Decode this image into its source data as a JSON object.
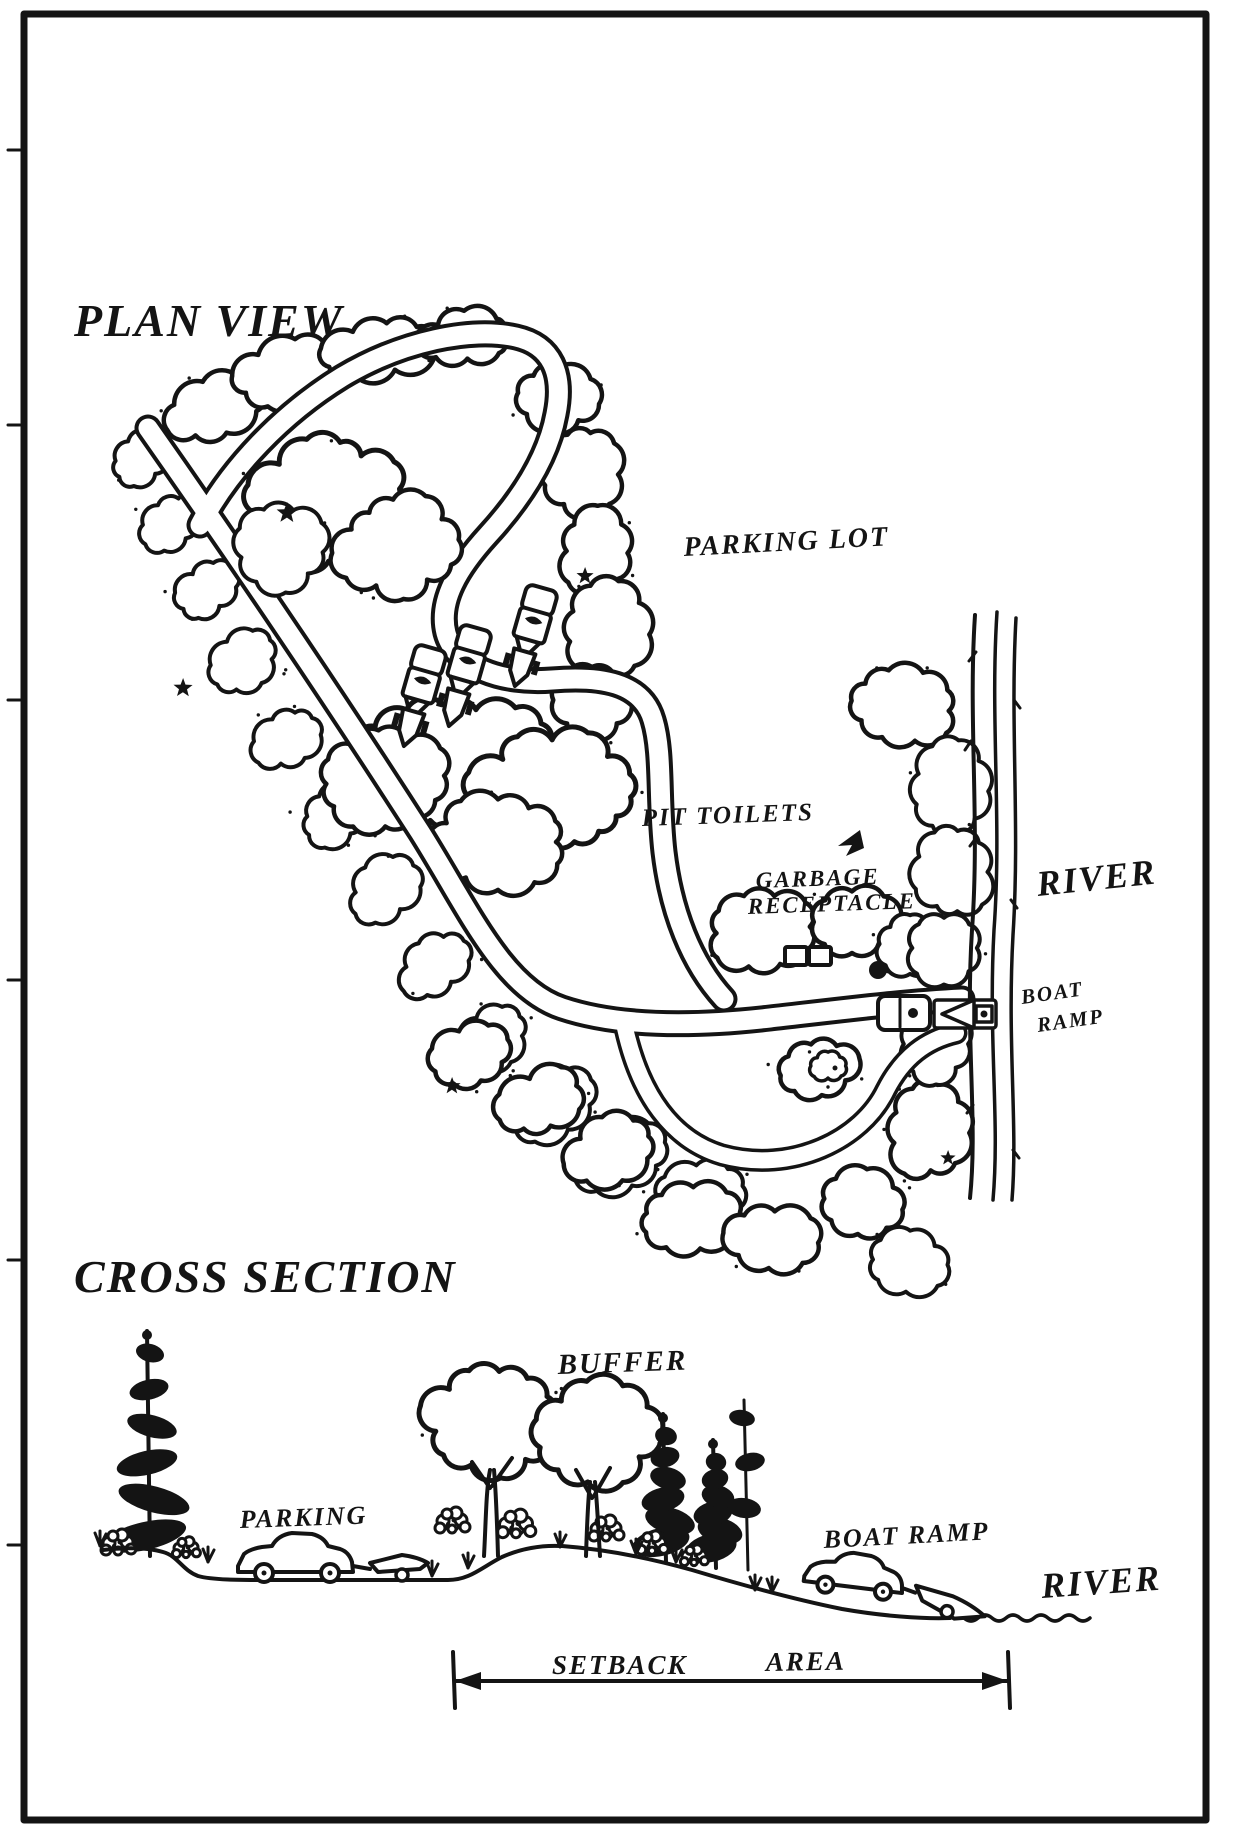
{
  "page": {
    "background": "#ffffff",
    "ink": "#141414"
  },
  "plan_view": {
    "title": "Plan View",
    "labels": {
      "parking_lot": "Parking Lot",
      "pit_toilets": "Pit Toilets",
      "garbage_line1": "Garbage",
      "garbage_line2": "Receptacle",
      "river": "River",
      "boat_line1": "Boat",
      "boat_line2": "Ramp"
    },
    "features": [
      "access-road",
      "parking-loop-road",
      "wooded-island",
      "car-with-boat-trailer",
      "pit-toilet-buildings",
      "garbage-receptacle",
      "turnaround-island",
      "boat-launch-vehicle",
      "river-shoreline"
    ]
  },
  "cross_section": {
    "title": "Cross Section",
    "labels": {
      "buffer": "Buffer",
      "parking": "Parking",
      "boat_ramp": "Boat Ramp",
      "river": "River",
      "setback_word1": "Setback",
      "setback_word2": "Area"
    }
  }
}
